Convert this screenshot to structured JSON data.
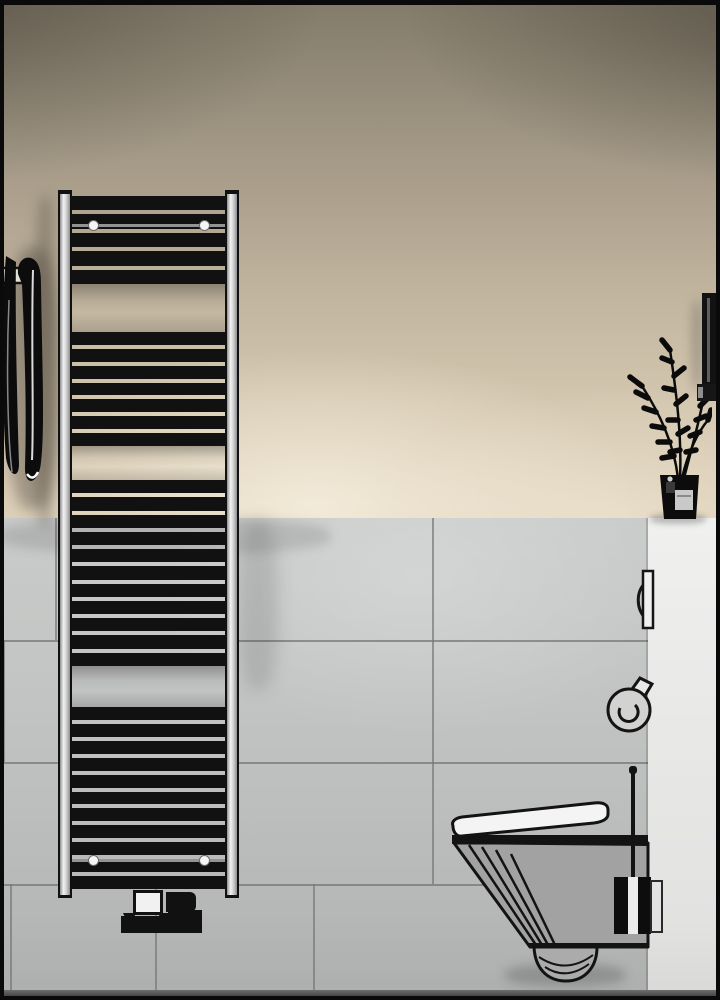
{
  "scene": {
    "description": "3D product render of a bathroom: black ladder towel radiator on beige wall over grey tiles, wall-hung toilet, toilet brush, plant on white half-wall, towel on left",
    "canvas": {
      "width": 720,
      "height": 1000
    },
    "wall_transition_y": 518
  },
  "colors": {
    "frame": "#0a0a0a",
    "ink": "#111111",
    "wall_beige": "#c7bba5",
    "wall_beige_dark": "#837b6a",
    "wall_beige_bright": "#e3d6c0",
    "tile_light": "#c9cbca",
    "tile_dark": "#adafae",
    "tile_joint": "#767877",
    "panel_white": "#ebebea",
    "floor_dark": "#3c3c3c",
    "radiator_black": "#0e0e0e",
    "rail_chrome": "#f3f3f3",
    "toilet_body_gray": "#a2a2a2",
    "toilet_lid_white": "#f4f4f4"
  },
  "tiles": {
    "horizontal_joints": [
      {
        "y": 640,
        "x1": 0,
        "x2": 648
      },
      {
        "y": 762,
        "x1": 0,
        "x2": 648
      },
      {
        "y": 884,
        "x1": 0,
        "x2": 648
      }
    ],
    "vertical_joints": [
      {
        "x": 55,
        "y1": 518,
        "y2": 640
      },
      {
        "x": 432,
        "y1": 518,
        "y2": 884
      },
      {
        "x": 3,
        "y1": 640,
        "y2": 762
      },
      {
        "x": 10,
        "y1": 884,
        "y2": 990
      },
      {
        "x": 155,
        "y1": 884,
        "y2": 990
      },
      {
        "x": 313,
        "y1": 884,
        "y2": 990
      }
    ]
  },
  "radiator": {
    "x": 58,
    "y": 190,
    "width": 181,
    "height": 710,
    "gap_px": 4,
    "groups": [
      {
        "start": 196,
        "end": 284,
        "bars": 5
      },
      {
        "start": 332,
        "end": 446,
        "bars": 7
      },
      {
        "start": 480,
        "end": 666,
        "bars": 11
      },
      {
        "start": 707,
        "end": 889,
        "bars": 11
      }
    ],
    "mount_rows": [
      {
        "y": 224,
        "dot_xs": [
          93,
          204
        ]
      },
      {
        "y": 859,
        "dot_xs": [
          93,
          204
        ]
      }
    ],
    "valve_parts": [
      {
        "name": "valve-pipe-bar",
        "cls": "p-black",
        "x": 121,
        "y": 916,
        "w": 80,
        "h": 17
      },
      {
        "name": "valve-step-block",
        "cls": "p-black",
        "x": 168,
        "y": 910,
        "w": 34,
        "h": 23
      },
      {
        "name": "valve-body",
        "cls": "p-black p-round",
        "x": 166,
        "y": 892,
        "w": 30,
        "h": 20
      },
      {
        "name": "valve-union",
        "cls": "p-white",
        "x": 133,
        "y": 890,
        "w": 30,
        "h": 25
      },
      {
        "name": "valve-arrow-left",
        "cls": "p-tri",
        "x": 123,
        "y": 913,
        "w": 13,
        "h": 14
      },
      {
        "name": "valve-arrow-right",
        "cls": "p-tri",
        "x": 158,
        "y": 913,
        "w": 13,
        "h": 14
      }
    ]
  },
  "shadows": [
    {
      "name": "wall-shadow-towel",
      "x": 6,
      "y": 248,
      "w": 54,
      "h": 262,
      "blur": 7,
      "color": "rgba(48,42,33,0.35)"
    },
    {
      "name": "wall-shadow-radiator-left",
      "x": 34,
      "y": 196,
      "w": 22,
      "h": 330,
      "blur": 6,
      "color": "rgba(58,52,42,0.30)"
    },
    {
      "name": "tile-shadow-radiator-right",
      "x": 238,
      "y": 520,
      "w": 40,
      "h": 170,
      "blur": 8,
      "color": "rgba(40,40,40,0.15)"
    },
    {
      "name": "tile-shadow-transition",
      "x": 0,
      "y": 518,
      "w": 330,
      "h": 36,
      "blur": 5,
      "color": "rgba(40,40,40,0.14)"
    },
    {
      "name": "tile-shadow-toilet",
      "x": 505,
      "y": 964,
      "w": 120,
      "h": 22,
      "blur": 5,
      "color": "rgba(20,20,20,0.20)"
    },
    {
      "name": "panel-shadow-plant",
      "x": 650,
      "y": 514,
      "w": 56,
      "h": 10,
      "blur": 3,
      "color": "rgba(20,20,20,0.25)"
    },
    {
      "name": "wall-shadow-bar",
      "x": 692,
      "y": 300,
      "w": 10,
      "h": 90,
      "blur": 5,
      "color": "rgba(50,45,38,0.28)"
    }
  ],
  "objects": {
    "towel": {
      "x": 0,
      "y": 240,
      "w": 56,
      "h": 256,
      "color": "#0c0c0c"
    },
    "plant": {
      "x": 600,
      "y": 332,
      "w": 112,
      "h": 190,
      "color": "#0b0b0b"
    },
    "wall_bar": {
      "x": 702,
      "y": 293,
      "w": 15,
      "h": 101,
      "color": "#121212"
    },
    "flush_plate": {
      "x": 624,
      "y": 563,
      "w": 34,
      "h": 70
    },
    "paper_holder": {
      "x": 598,
      "y": 670,
      "w": 64,
      "h": 78
    },
    "toilet": {
      "x": 435,
      "y": 758,
      "w": 235,
      "h": 232
    },
    "brush_set": {
      "x": 614,
      "y": 768,
      "w": 48,
      "h": 167
    }
  }
}
